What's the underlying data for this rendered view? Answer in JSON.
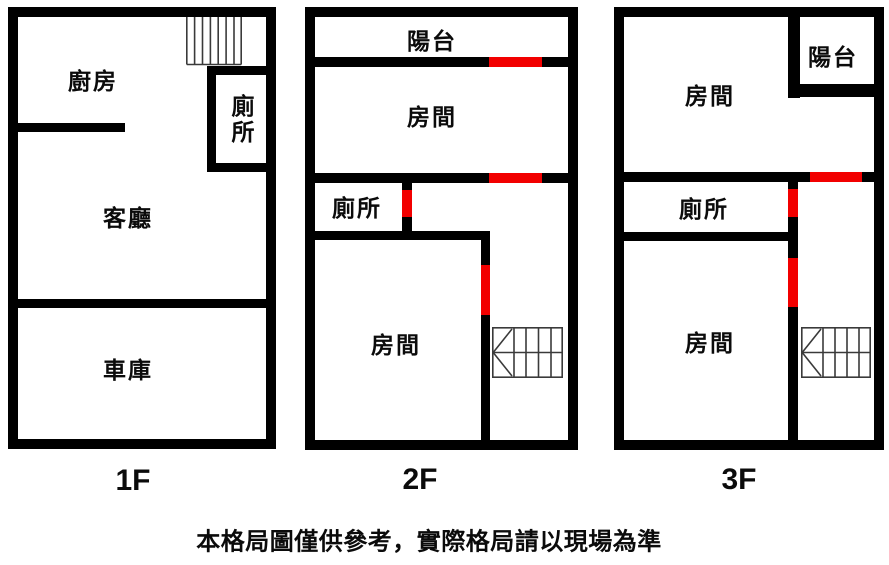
{
  "disclaimer": "本格局圖僅供參考，實際格局請以現場為準",
  "colors": {
    "wall": "#000000",
    "door_marker": "#f20000",
    "stairs_stroke": "#3a3a3a",
    "background": "#ffffff"
  },
  "floors": [
    {
      "name": "1F",
      "rooms": {
        "kitchen": "廚房",
        "toilet": "廁所",
        "living": "客廳",
        "garage": "車庫"
      }
    },
    {
      "name": "2F",
      "rooms": {
        "balcony": "陽台",
        "room_upper": "房間",
        "toilet": "廁所",
        "room_lower": "房間"
      }
    },
    {
      "name": "3F",
      "rooms": {
        "room_upper": "房間",
        "balcony": "陽台",
        "toilet": "廁所",
        "room_lower": "房間"
      }
    }
  ]
}
